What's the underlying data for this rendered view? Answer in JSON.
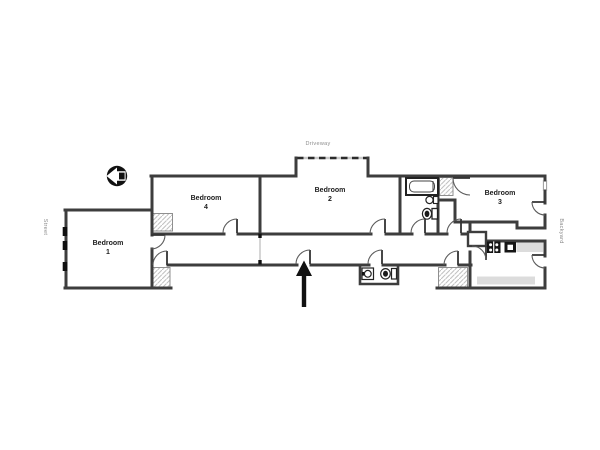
{
  "plan": {
    "type": "apartment-floor-plan",
    "background": "#ffffff",
    "wall_color": "#3d3d3d",
    "counter_color": "#dcdcdc",
    "hatch_line_color": "#c2c2c2",
    "label_color": "#1c1c1c",
    "muted_label_color": "#8c8c8c"
  },
  "labels": {
    "driveway": "Driveway",
    "street": "Street",
    "backyard": "Backyard"
  },
  "rooms": [
    {
      "name": "Bedroom",
      "number": "1"
    },
    {
      "name": "Bedroom",
      "number": "4"
    },
    {
      "name": "Bedroom",
      "number": "2"
    },
    {
      "name": "Bedroom",
      "number": "3"
    }
  ],
  "icons": {
    "compass": "compass-west-icon",
    "entrance": "entrance-arrow-icon",
    "fixtures": [
      "bathtub-icon",
      "sink-icon",
      "toilet-icon",
      "wc-sink-icon",
      "wc-toilet-icon",
      "stove-icon",
      "kitchen-appliance-icon"
    ]
  }
}
